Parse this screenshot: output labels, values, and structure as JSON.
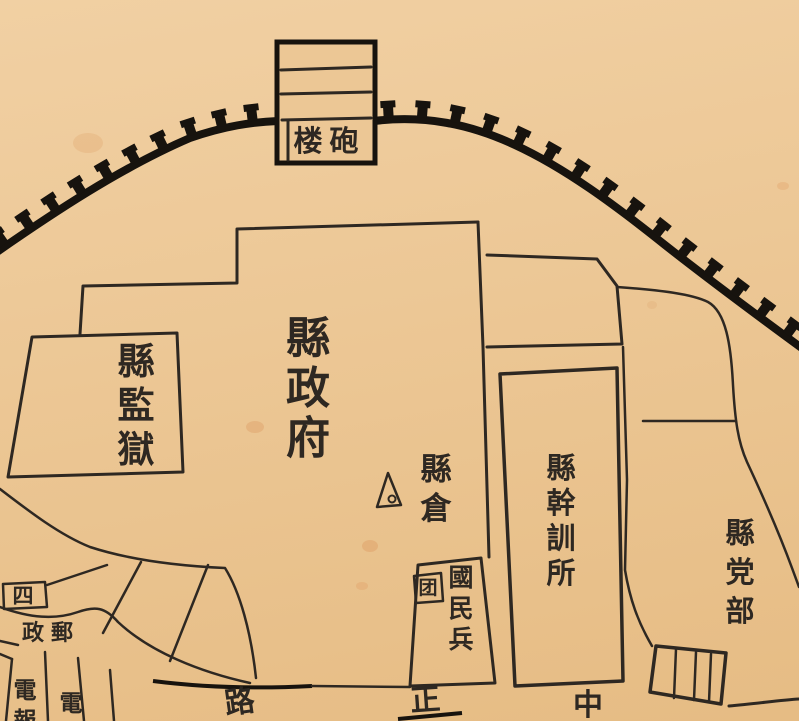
{
  "document": {
    "type": "scanned hand-drawn historical county-seat map",
    "area_title": "縣政府 county government compound inside city wall"
  },
  "colors": {
    "paper": "#ecc795",
    "ink": "#2e2822",
    "wall": "#17130e",
    "stain": "#d98a4e"
  },
  "map": {
    "road_name_reading_rtl": "中正路",
    "labels": [
      {
        "id": "gun-tower",
        "text": "楼砲",
        "reading": "砲楼 (gun tower)",
        "orientation": "horizontal",
        "x": 308,
        "y": 151,
        "size": 29,
        "gap": 36
      },
      {
        "id": "county-government",
        "text": "縣政府",
        "orientation": "vertical",
        "x": 308,
        "y": 353,
        "size": 44,
        "gap": 50
      },
      {
        "id": "county-prison",
        "text": "縣監獄",
        "orientation": "vertical",
        "x": 136,
        "y": 374,
        "size": 37,
        "gap": 44
      },
      {
        "id": "county-granary",
        "text": "縣倉",
        "orientation": "vertical",
        "x": 436,
        "y": 480,
        "size": 31,
        "gap": 39
      },
      {
        "id": "cadre-training-institute",
        "text": "縣幹訓所",
        "orientation": "vertical",
        "x": 561,
        "y": 478,
        "size": 29,
        "gap": 35
      },
      {
        "id": "county-party-hq",
        "text": "縣党部",
        "orientation": "vertical",
        "x": 740,
        "y": 543,
        "size": 29,
        "gap": 39
      },
      {
        "id": "national-militia",
        "text": "國民兵",
        "orientation": "vertical",
        "x": 461,
        "y": 586,
        "size": 25,
        "gap": 31
      },
      {
        "id": "militia-corps-char",
        "text": "团",
        "orientation": "vertical",
        "x": 428,
        "y": 594,
        "size": 19,
        "gap": 24
      },
      {
        "id": "post-office",
        "text": "郵政",
        "orientation": "horizontal-rtl",
        "x": 62,
        "y": 640,
        "size": 22,
        "gap": 29
      },
      {
        "id": "parcel-four",
        "text": "四",
        "orientation": "horizontal",
        "x": 23,
        "y": 603,
        "size": 21,
        "gap": 24
      },
      {
        "id": "telegraph",
        "text": "電報",
        "orientation": "vertical",
        "x": 25,
        "y": 698,
        "size": 23,
        "gap": 30
      },
      {
        "id": "telephone",
        "text": "電",
        "orientation": "vertical",
        "x": 71,
        "y": 711,
        "size": 23,
        "gap": 30
      },
      {
        "id": "road-char-lu",
        "text": "路",
        "orientation": "horizontal",
        "x": 241,
        "y": 712,
        "size": 30,
        "gap": 32,
        "rotate": -8
      },
      {
        "id": "road-char-zheng",
        "text": "正",
        "orientation": "horizontal",
        "x": 426,
        "y": 710,
        "size": 30,
        "gap": 32,
        "rotate": -4
      },
      {
        "id": "road-char-zhong",
        "text": "中",
        "orientation": "horizontal",
        "x": 588,
        "y": 715,
        "size": 30,
        "gap": 32
      }
    ],
    "symbols": [
      {
        "id": "survey-triangle",
        "desc": "triangle marker with dot beside county granary",
        "x": 389,
        "y": 490
      }
    ]
  }
}
